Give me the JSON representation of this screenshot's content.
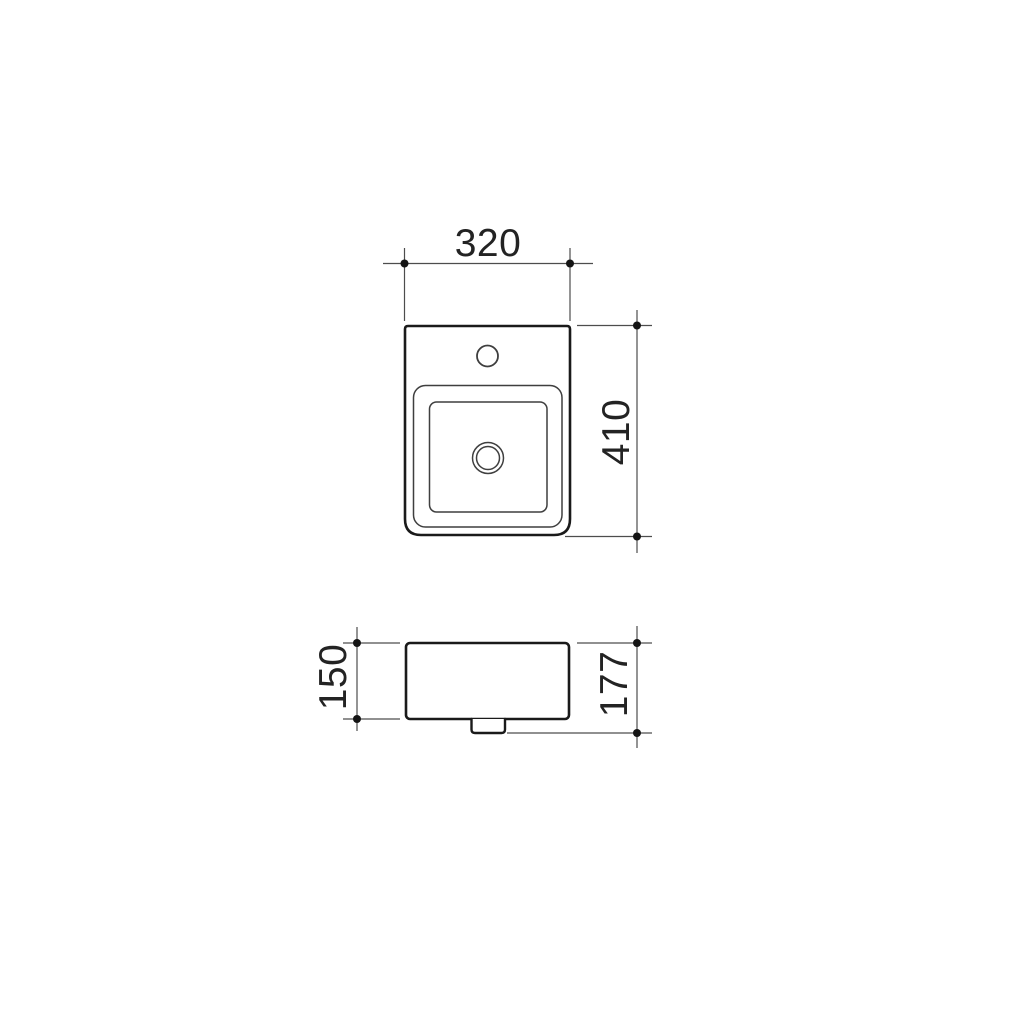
{
  "drawing": {
    "background": "#ffffff",
    "colors": {
      "outline": "#1a1a1a",
      "detail": "#3f3f3f",
      "dimension": "#4d4d4d",
      "label": "#232323"
    },
    "views": {
      "plan": {
        "name": "plan-view",
        "features": [
          "tap-hole",
          "basin-rim",
          "basin-bowl",
          "waste-outlet"
        ]
      },
      "side": {
        "name": "side-elevation-view",
        "features": [
          "body",
          "waste-outlet"
        ]
      }
    },
    "dimensions": {
      "width": {
        "value": "320",
        "orientation": "horizontal"
      },
      "depth": {
        "value": "410",
        "orientation": "vertical"
      },
      "body_height": {
        "value": "150",
        "orientation": "vertical"
      },
      "total_height": {
        "value": "177",
        "orientation": "vertical"
      }
    }
  }
}
